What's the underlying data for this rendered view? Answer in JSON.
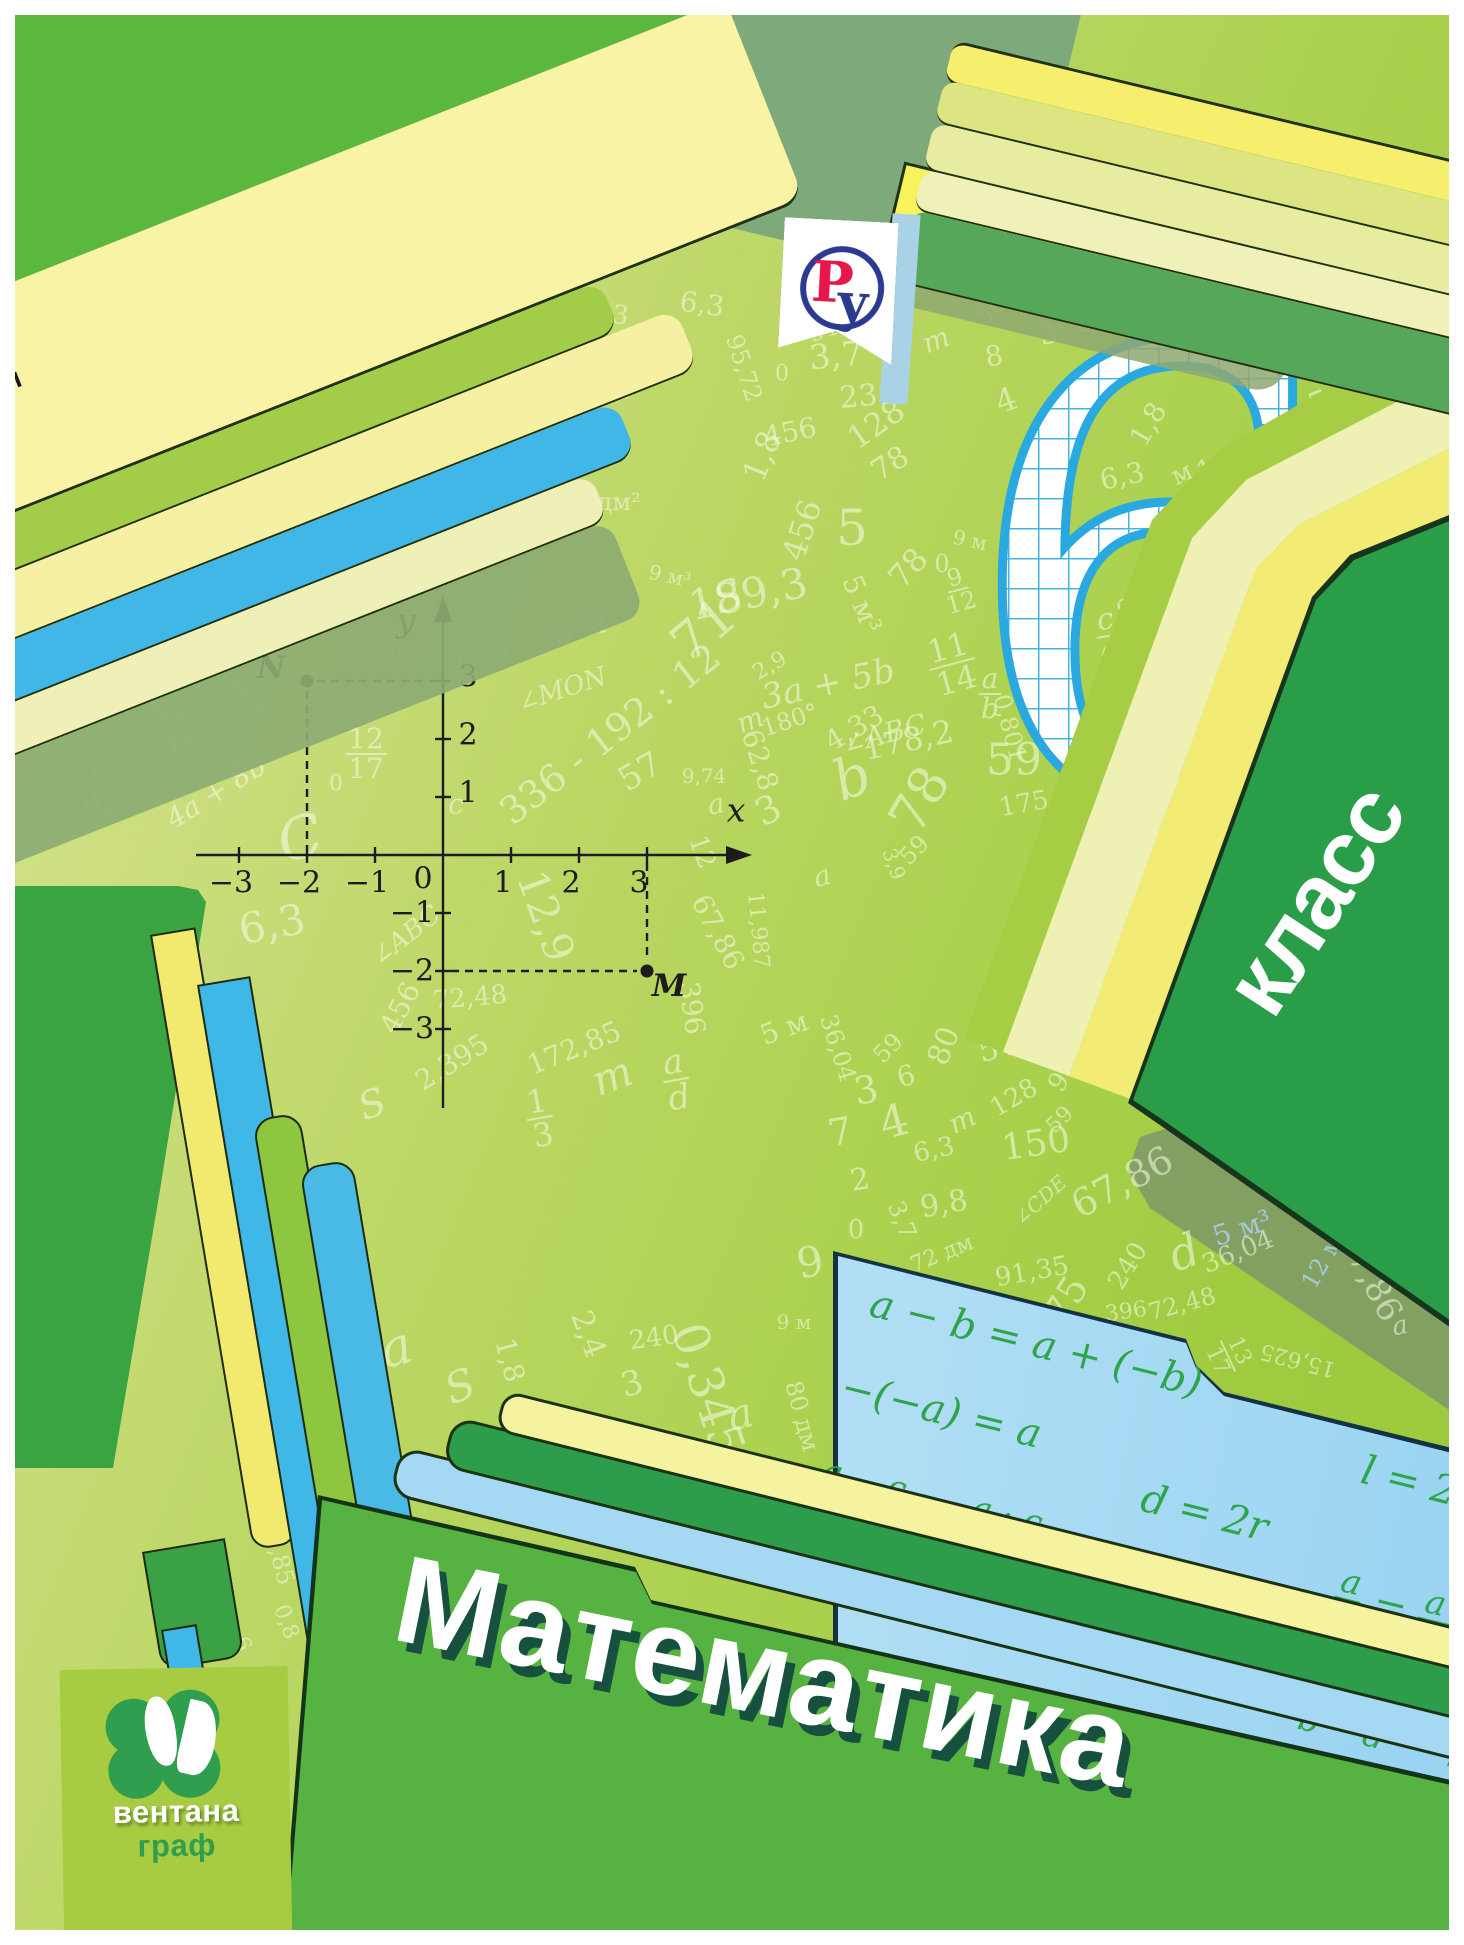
{
  "authors": [
    "А. Г. Мерзляк",
    "В. Б. Полонский",
    "М. С. Якир"
  ],
  "logo_ru": {
    "letter_p": "Р",
    "letter_u": "у"
  },
  "grade": {
    "number": "6",
    "label": "класс"
  },
  "title": "Математика",
  "publisher": {
    "line1": "вентана",
    "line2": "граф"
  },
  "colors": {
    "accent_green": "#2f9e4e",
    "folder_green": "#57b341",
    "stripe_blue": "#3fb8e8",
    "card_blue": "#bfe4f7",
    "formula_green": "#2ea54b",
    "grid_blue": "#3fb2e4",
    "logo_red": "#e8174b",
    "logo_navy": "#2b3990"
  },
  "plane": {
    "x_label": "x",
    "y_label": "y",
    "origin_label": "0",
    "x_ticks": [
      {
        "v": -3,
        "l": "−3"
      },
      {
        "v": -2,
        "l": "−2"
      },
      {
        "v": -1,
        "l": "−1"
      },
      {
        "v": 1,
        "l": "1"
      },
      {
        "v": 2,
        "l": "2"
      },
      {
        "v": 3,
        "l": "3"
      }
    ],
    "y_ticks": [
      {
        "v": 3,
        "l": "3"
      },
      {
        "v": 2,
        "l": "2"
      },
      {
        "v": 1,
        "l": "1"
      },
      {
        "v": -1,
        "l": "−1"
      },
      {
        "v": -2,
        "l": "−2"
      },
      {
        "v": -3,
        "l": "−3"
      }
    ],
    "points": [
      {
        "name": "N",
        "x": -2,
        "y": 3,
        "label_side": "left"
      },
      {
        "name": "M",
        "x": 3,
        "y": -2,
        "label_side": "right"
      }
    ]
  },
  "formulas": [
    {
      "x": 28,
      "y": 12,
      "seg": [
        {
          "t": "a − b = a + (−b)"
        }
      ]
    },
    {
      "x": 545,
      "y": 56,
      "seg": [
        {
          "t": "l = 2πr"
        }
      ]
    },
    {
      "x": 20,
      "y": 100,
      "seg": [
        {
          "t": "−(−a) = a"
        }
      ]
    },
    {
      "x": 338,
      "y": 136,
      "seg": [
        {
          "t": "d = 2r"
        }
      ]
    },
    {
      "x": 18,
      "y": 192,
      "seg": [
        {
          "f": [
            "a",
            "b"
          ]
        },
        {
          "t": " · "
        },
        {
          "f": [
            "c",
            "d"
          ]
        },
        {
          "t": " = "
        },
        {
          "f": [
            "a · c",
            "b · d"
          ]
        }
      ]
    },
    {
      "x": 322,
      "y": 250,
      "seg": [
        {
          "t": "|a| = |−a|"
        }
      ]
    },
    {
      "x": 548,
      "y": 174,
      "seg": [
        {
          "f": [
            "a",
            "b"
          ]
        },
        {
          "t": " = "
        },
        {
          "f": [
            "a · n",
            "b · n"
          ]
        }
      ]
    },
    {
      "x": 540,
      "y": 282,
      "seg": [
        {
          "f": [
            "a",
            "b"
          ]
        },
        {
          "t": " : "
        },
        {
          "f": [
            "c",
            "d"
          ]
        },
        {
          "t": " = "
        },
        {
          "f": [
            "a · d",
            "b · c"
          ]
        }
      ]
    }
  ],
  "scatter": [
    {
      "t": "м",
      "x": 636,
      "y": 142,
      "r": -75,
      "s": 26
    },
    {
      "t": "150",
      "x": 676,
      "y": 124,
      "r": -58,
      "s": 38,
      "c": "b"
    },
    {
      "t": "396",
      "x": 730,
      "y": 172,
      "r": -42,
      "s": 38,
      "c": "b"
    },
    {
      "t": "100",
      "x": 688,
      "y": 232,
      "r": -18,
      "s": 36
    },
    {
      "t": "545",
      "x": 816,
      "y": 310,
      "r": -28,
      "s": 38
    },
    {
      "t": "1,50",
      "x": 560,
      "y": 118,
      "r": -58,
      "s": 32
    },
    {
      "t": "396",
      "x": 492,
      "y": 150,
      "r": -40,
      "s": 32
    },
    {
      "t": "100",
      "x": 548,
      "y": 162,
      "r": -12,
      "s": 26
    },
    {
      "t": "545",
      "x": 668,
      "y": 190,
      "r": -25,
      "s": 28
    },
    {
      "t": "128",
      "x": 612,
      "y": 236,
      "r": 6,
      "s": 24
    },
    {
      "t": "1,8",
      "x": 540,
      "y": 250,
      "r": -70,
      "s": 24
    },
    {
      "t": "4",
      "x": 558,
      "y": 300,
      "r": -15,
      "s": 42
    },
    {
      "t": "6,3",
      "x": 608,
      "y": 314,
      "r": 8,
      "s": 26
    },
    {
      "t": "172,85",
      "x": 550,
      "y": 388,
      "r": -8,
      "s": 26
    },
    {
      "t": "0,801",
      "x": 614,
      "y": 372,
      "r": 80,
      "s": 24
    },
    {
      "t": "95,72",
      "x": 744,
      "y": 368,
      "r": 72,
      "s": 24
    },
    {
      "t": "6,3",
      "x": 702,
      "y": 304,
      "r": 8,
      "s": 28
    },
    {
      "t": "91,35",
      "x": 842,
      "y": 324,
      "r": -18,
      "s": 24
    },
    {
      "t": "3,7",
      "x": 836,
      "y": 356,
      "r": -5,
      "s": 34
    },
    {
      "t": "231",
      "x": 868,
      "y": 396,
      "r": -5,
      "s": 30
    },
    {
      "t": "456",
      "x": 790,
      "y": 432,
      "r": -12,
      "s": 28
    },
    {
      "t": "1,8",
      "x": 762,
      "y": 456,
      "r": -68,
      "s": 32
    },
    {
      "t": "128",
      "x": 876,
      "y": 424,
      "r": -35,
      "s": 32
    },
    {
      "t": "78",
      "x": 890,
      "y": 464,
      "r": -32,
      "s": 30
    },
    {
      "t": "m",
      "x": 936,
      "y": 340,
      "r": -20,
      "s": 28
    },
    {
      "t": "0",
      "x": 782,
      "y": 374,
      "r": 0,
      "s": 22
    },
    {
      "t": "58",
      "x": 990,
      "y": 310,
      "r": -40,
      "s": 24
    },
    {
      "t": "3",
      "x": 1048,
      "y": 334,
      "r": -15,
      "s": 28
    },
    {
      "t": "8",
      "x": 994,
      "y": 356,
      "r": -10,
      "s": 28
    },
    {
      "t": "4",
      "x": 1006,
      "y": 400,
      "r": -20,
      "s": 32
    },
    {
      "t": "c",
      "x": 1084,
      "y": 320,
      "r": -15,
      "s": 32
    },
    {
      "t": "36,04",
      "x": 1126,
      "y": 316,
      "r": 75,
      "s": 24
    },
    {
      "t": "15,625",
      "x": 1016,
      "y": 236,
      "r": 85,
      "s": 22
    },
    {
      "t": "11,987",
      "x": 1062,
      "y": 278,
      "r": 195,
      "s": 22
    },
    {
      "t": "a",
      "x": 1202,
      "y": 318,
      "r": -10,
      "s": 32
    },
    {
      "t": "4,33",
      "x": 1244,
      "y": 260,
      "r": 82,
      "s": 26
    },
    {
      "t": "S",
      "x": 1296,
      "y": 242,
      "r": -15,
      "s": 42
    },
    {
      "t": "175",
      "x": 1354,
      "y": 290,
      "r": -25,
      "s": 36
    },
    {
      "t": "178,2",
      "x": 1290,
      "y": 322,
      "r": 0,
      "s": 26
    },
    {
      "t": "p",
      "x": 1366,
      "y": 332,
      "r": -20,
      "s": 42
    },
    {
      "t": "545",
      "x": 1340,
      "y": 396,
      "r": -22,
      "s": 34
    },
    {
      "t": "128",
      "x": 1224,
      "y": 462,
      "r": -28,
      "s": 30
    },
    {
      "t": "1,8",
      "x": 1148,
      "y": 424,
      "r": -60,
      "s": 28
    },
    {
      "t": "6,3",
      "x": 1122,
      "y": 476,
      "r": -12,
      "s": 28
    },
    {
      "t": "м",
      "x": 1182,
      "y": 474,
      "r": -25,
      "s": 26
    },
    {
      "t": "91,35",
      "x": 1148,
      "y": 588,
      "r": -45,
      "s": 26
    },
    {
      "t": "c/d",
      "x": 1108,
      "y": 636,
      "f": 1,
      "r": -10,
      "s": 30
    },
    {
      "t": "80 дм²",
      "x": 600,
      "y": 502,
      "r": 0,
      "s": 24
    },
    {
      "t": "59°",
      "x": 340,
      "y": 456,
      "r": -18,
      "s": 32
    },
    {
      "t": "10/19",
      "x": 454,
      "y": 424,
      "f": 1,
      "r": -18,
      "s": 28
    },
    {
      "t": "90°",
      "x": 520,
      "y": 442,
      "r": 75,
      "s": 26
    },
    {
      "t": "∠OAB = 90°",
      "x": 434,
      "y": 404,
      "r": -52,
      "s": 20
    },
    {
      "t": "S",
      "x": 728,
      "y": 596,
      "r": -20,
      "s": 42
    },
    {
      "t": "c",
      "x": 122,
      "y": 508,
      "r": -20,
      "s": 32
    },
    {
      "t": "∠ABC",
      "x": 50,
      "y": 552,
      "r": -12,
      "s": 24
    },
    {
      "t": "5",
      "x": 38,
      "y": 610,
      "r": -15,
      "s": 26
    },
    {
      "t": "0",
      "x": 80,
      "y": 582,
      "r": 0,
      "s": 22
    },
    {
      "t": "∠KLM",
      "x": 198,
      "y": 634,
      "r": -38,
      "s": 26
    },
    {
      "t": "1/6",
      "x": 168,
      "y": 726,
      "f": 1,
      "r": -35,
      "s": 38
    },
    {
      "t": "15/20",
      "x": 86,
      "y": 790,
      "f": 1,
      "r": -25,
      "s": 32
    },
    {
      "t": "15/20",
      "x": 238,
      "y": 692,
      "f": 1,
      "r": -30,
      "s": 28
    },
    {
      "t": "a",
      "x": 268,
      "y": 650,
      "r": -15,
      "s": 32
    },
    {
      "t": "4a + 8b",
      "x": 216,
      "y": 792,
      "r": -32,
      "s": 28
    },
    {
      "t": "12/17",
      "x": 366,
      "y": 754,
      "f": 1,
      "r": 0,
      "s": 28
    },
    {
      "t": "q",
      "x": 594,
      "y": 616,
      "r": -15,
      "s": 34
    },
    {
      "t": "b",
      "x": 562,
      "y": 632,
      "r": -25,
      "s": 34
    },
    {
      "t": "13,64",
      "x": 482,
      "y": 656,
      "r": -10,
      "s": 20
    },
    {
      "t": "2,9",
      "x": 388,
      "y": 660,
      "r": -20,
      "s": 22
    },
    {
      "t": "∠MON",
      "x": 562,
      "y": 690,
      "r": -18,
      "s": 26
    },
    {
      "t": "336 - 192 : 12",
      "x": 610,
      "y": 734,
      "r": -38,
      "s": 38
    },
    {
      "t": "57",
      "x": 640,
      "y": 772,
      "r": -30,
      "s": 34
    },
    {
      "t": "C",
      "x": 300,
      "y": 838,
      "r": -15,
      "s": 58
    },
    {
      "t": "0",
      "x": 336,
      "y": 784,
      "r": 0,
      "s": 22
    },
    {
      "t": "6,3",
      "x": 272,
      "y": 924,
      "r": -10,
      "s": 42
    },
    {
      "t": "12,9",
      "x": 546,
      "y": 916,
      "r": 70,
      "s": 42
    },
    {
      "t": "∠ABC",
      "x": 406,
      "y": 936,
      "r": -38,
      "s": 26
    },
    {
      "t": "c",
      "x": 456,
      "y": 804,
      "r": 0,
      "s": 28
    },
    {
      "t": "456",
      "x": 400,
      "y": 1008,
      "r": -62,
      "s": 28
    },
    {
      "t": "72,48",
      "x": 470,
      "y": 998,
      "r": -5,
      "s": 26
    },
    {
      "t": "2,395",
      "x": 452,
      "y": 1062,
      "r": -32,
      "s": 28
    },
    {
      "t": "172,85",
      "x": 574,
      "y": 1048,
      "r": -22,
      "s": 28
    },
    {
      "t": "1/3",
      "x": 540,
      "y": 1118,
      "f": 1,
      "r": -10,
      "s": 32
    },
    {
      "t": "396",
      "x": 692,
      "y": 1008,
      "r": 82,
      "s": 28
    },
    {
      "t": "a/d",
      "x": 676,
      "y": 1080,
      "f": 1,
      "r": -10,
      "s": 34
    },
    {
      "t": "m",
      "x": 612,
      "y": 1076,
      "r": -20,
      "s": 42
    },
    {
      "t": "S",
      "x": 372,
      "y": 1104,
      "r": -20,
      "s": 38
    },
    {
      "t": "11,987",
      "x": 758,
      "y": 930,
      "r": 85,
      "s": 22
    },
    {
      "t": "67,86",
      "x": 718,
      "y": 932,
      "r": 62,
      "s": 28
    },
    {
      "t": "12",
      "x": 702,
      "y": 852,
      "r": 70,
      "s": 26
    },
    {
      "t": "9,74",
      "x": 704,
      "y": 776,
      "r": 0,
      "s": 20
    },
    {
      "t": "a",
      "x": 716,
      "y": 804,
      "r": -10,
      "s": 28
    },
    {
      "t": "3",
      "x": 768,
      "y": 810,
      "r": -25,
      "s": 38
    },
    {
      "t": "a",
      "x": 822,
      "y": 876,
      "r": -15,
      "s": 28
    },
    {
      "t": "3,9",
      "x": 894,
      "y": 864,
      "r": 70,
      "s": 20
    },
    {
      "t": "59",
      "x": 914,
      "y": 850,
      "r": -45,
      "s": 24
    },
    {
      "t": "4,33",
      "x": 854,
      "y": 728,
      "r": -30,
      "s": 28
    },
    {
      "t": "178,2",
      "x": 908,
      "y": 740,
      "r": -12,
      "s": 32
    },
    {
      "t": "180°",
      "x": 790,
      "y": 720,
      "r": -18,
      "s": 24
    },
    {
      "t": "m",
      "x": 750,
      "y": 720,
      "r": -20,
      "s": 28
    },
    {
      "t": "a/b",
      "x": 990,
      "y": 694,
      "f": 1,
      "r": 0,
      "s": 28
    },
    {
      "t": "0,801",
      "x": 1010,
      "y": 728,
      "r": 75,
      "s": 24
    },
    {
      "t": "175",
      "x": 1024,
      "y": 804,
      "r": -10,
      "s": 26
    },
    {
      "t": "0",
      "x": 942,
      "y": 564,
      "r": 0,
      "s": 24
    },
    {
      "t": "78",
      "x": 920,
      "y": 800,
      "r": -60,
      "s": 52
    },
    {
      "t": "b",
      "x": 852,
      "y": 778,
      "r": -20,
      "s": 56
    },
    {
      "t": "59",
      "x": 1014,
      "y": 760,
      "r": 0,
      "s": 44
    },
    {
      "t": "456",
      "x": 802,
      "y": 530,
      "r": -72,
      "s": 32
    },
    {
      "t": "5",
      "x": 852,
      "y": 528,
      "r": 0,
      "s": 50
    },
    {
      "t": "9 м³",
      "x": 670,
      "y": 576,
      "r": 12,
      "s": 20
    },
    {
      "t": "189,3",
      "x": 748,
      "y": 594,
      "r": -12,
      "s": 42
    },
    {
      "t": "5 м³",
      "x": 862,
      "y": 604,
      "r": 68,
      "s": 28
    },
    {
      "t": "78",
      "x": 908,
      "y": 568,
      "r": -48,
      "s": 32
    },
    {
      "t": "9/12",
      "x": 958,
      "y": 590,
      "f": 1,
      "r": -15,
      "s": 24
    },
    {
      "t": "11/14",
      "x": 952,
      "y": 664,
      "f": 1,
      "r": -15,
      "s": 32
    },
    {
      "t": "71",
      "x": 704,
      "y": 630,
      "r": -40,
      "s": 52
    },
    {
      "t": "2,9",
      "x": 770,
      "y": 666,
      "r": -30,
      "s": 22
    },
    {
      "t": "3a + 5b",
      "x": 828,
      "y": 684,
      "r": -12,
      "s": 34
    },
    {
      "t": "∠ABC",
      "x": 884,
      "y": 734,
      "r": -15,
      "s": 28
    },
    {
      "t": "62,8",
      "x": 760,
      "y": 760,
      "r": 72,
      "s": 28
    },
    {
      "t": "9 м",
      "x": 970,
      "y": 540,
      "r": 12,
      "s": 20
    },
    {
      "t": "36,04",
      "x": 838,
      "y": 1048,
      "r": 72,
      "s": 24
    },
    {
      "t": "5 м",
      "x": 784,
      "y": 1028,
      "r": -20,
      "s": 28
    },
    {
      "t": "59",
      "x": 888,
      "y": 1048,
      "r": -45,
      "s": 24
    },
    {
      "t": "80",
      "x": 944,
      "y": 1046,
      "r": -68,
      "s": 30
    },
    {
      "t": "545",
      "x": 1008,
      "y": 1044,
      "r": -15,
      "s": 32
    },
    {
      "t": "96 м",
      "x": 1072,
      "y": 1064,
      "r": -55,
      "s": 26
    },
    {
      "t": "128",
      "x": 1014,
      "y": 1098,
      "r": -30,
      "s": 26
    },
    {
      "t": "59",
      "x": 1060,
      "y": 1120,
      "r": -45,
      "s": 22
    },
    {
      "t": "3",
      "x": 866,
      "y": 1090,
      "r": -10,
      "s": 38
    },
    {
      "t": "6",
      "x": 906,
      "y": 1076,
      "r": -15,
      "s": 28
    },
    {
      "t": "7",
      "x": 840,
      "y": 1132,
      "r": -10,
      "s": 38
    },
    {
      "t": "4",
      "x": 894,
      "y": 1122,
      "r": -15,
      "s": 44
    },
    {
      "t": "2",
      "x": 860,
      "y": 1180,
      "r": -10,
      "s": 30
    },
    {
      "t": "6,3",
      "x": 934,
      "y": 1150,
      "r": -12,
      "s": 26
    },
    {
      "t": "m",
      "x": 962,
      "y": 1120,
      "r": -25,
      "s": 28
    },
    {
      "t": "150",
      "x": 1036,
      "y": 1144,
      "r": -8,
      "s": 36
    },
    {
      "t": "67,86",
      "x": 1122,
      "y": 1182,
      "r": -28,
      "s": 38
    },
    {
      "t": "9,8",
      "x": 944,
      "y": 1204,
      "r": -10,
      "s": 30
    },
    {
      "t": "3,7",
      "x": 902,
      "y": 1220,
      "r": 68,
      "s": 24
    },
    {
      "t": "∠CDE",
      "x": 1040,
      "y": 1200,
      "r": -42,
      "s": 20
    },
    {
      "t": "0",
      "x": 856,
      "y": 1230,
      "r": 0,
      "s": 26
    },
    {
      "t": "9",
      "x": 810,
      "y": 1262,
      "r": -10,
      "s": 42
    },
    {
      "t": "72 дм",
      "x": 942,
      "y": 1254,
      "r": -22,
      "s": 22
    },
    {
      "t": "91,35",
      "x": 1032,
      "y": 1272,
      "r": -10,
      "s": 26
    },
    {
      "t": "36,04",
      "x": 1238,
      "y": 1252,
      "r": -22,
      "s": 26
    },
    {
      "t": "240",
      "x": 1128,
      "y": 1266,
      "r": -58,
      "s": 26
    },
    {
      "t": "d",
      "x": 1184,
      "y": 1252,
      "r": -20,
      "s": 46
    },
    {
      "t": "67,86",
      "x": 1370,
      "y": 1276,
      "r": 62,
      "s": 34
    },
    {
      "t": "a",
      "x": 1400,
      "y": 1326,
      "r": -10,
      "s": 26
    },
    {
      "t": "396",
      "x": 1126,
      "y": 1312,
      "r": -8,
      "s": 22
    },
    {
      "t": "72,48",
      "x": 1182,
      "y": 1304,
      "r": -15,
      "s": 24
    },
    {
      "t": "75",
      "x": 1066,
      "y": 1300,
      "r": -58,
      "s": 38
    },
    {
      "t": "13/17",
      "x": 1228,
      "y": 1356,
      "f": 1,
      "r": 65,
      "s": 22
    },
    {
      "t": "15,625",
      "x": 1298,
      "y": 1360,
      "r": 195,
      "s": 22
    },
    {
      "t": "q",
      "x": 1420,
      "y": 1244,
      "r": -70,
      "s": 38,
      "c": "b"
    },
    {
      "t": "m",
      "x": 1204,
      "y": 1112,
      "r": -15,
      "s": 28,
      "c": "b"
    },
    {
      "t": "12 м",
      "x": 1322,
      "y": 1262,
      "r": -60,
      "s": 24,
      "c": "b"
    },
    {
      "t": "5 м³",
      "x": 1242,
      "y": 1228,
      "r": -18,
      "s": 28,
      "c": "b"
    },
    {
      "t": "a",
      "x": 396,
      "y": 1348,
      "r": -15,
      "s": 52
    },
    {
      "t": "S",
      "x": 460,
      "y": 1386,
      "r": -20,
      "s": 42
    },
    {
      "t": "2,675",
      "x": 356,
      "y": 1424,
      "r": -15,
      "s": 30
    },
    {
      "t": "1,8",
      "x": 510,
      "y": 1360,
      "r": 75,
      "s": 28
    },
    {
      "t": "3",
      "x": 632,
      "y": 1384,
      "r": -15,
      "s": 34
    },
    {
      "t": "2,4",
      "x": 588,
      "y": 1334,
      "r": 70,
      "s": 30
    },
    {
      "t": "240",
      "x": 654,
      "y": 1338,
      "r": -8,
      "s": 26
    },
    {
      "t": "0,345",
      "x": 708,
      "y": 1390,
      "r": 72,
      "s": 48
    },
    {
      "t": "a",
      "x": 740,
      "y": 1414,
      "r": -15,
      "s": 42
    },
    {
      "t": "80 дм",
      "x": 802,
      "y": 1416,
      "r": 75,
      "s": 24
    },
    {
      "t": "9 м",
      "x": 794,
      "y": 1322,
      "r": 0,
      "s": 20
    },
    {
      "t": "58",
      "x": 302,
      "y": 1474,
      "r": 75,
      "s": 28
    },
    {
      "t": "172,85",
      "x": 276,
      "y": 1544,
      "r": 75,
      "s": 24
    },
    {
      "t": "0,8",
      "x": 286,
      "y": 1622,
      "r": 70,
      "s": 22
    },
    {
      "t": "8",
      "x": 322,
      "y": 1612,
      "r": -60,
      "s": 22
    },
    {
      "t": "6",
      "x": 242,
      "y": 1644,
      "r": 70,
      "s": 22
    }
  ]
}
